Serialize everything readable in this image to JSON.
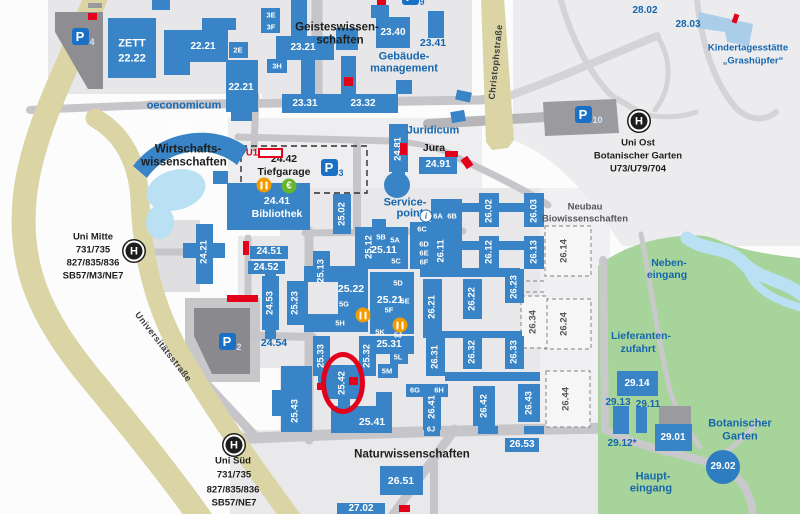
{
  "map": {
    "colors": {
      "building_blue": "#3884c6",
      "light_building": "#aacdea",
      "garage_gray": "#8e8e92",
      "road_gray": "#c6c6ca",
      "major_road_beige": "#dbd5a6",
      "green": "#a6d49a",
      "water": "#b9e1f3",
      "highlight_red": "#e2001a",
      "label_blue": "#1566ad",
      "text_black": "#1d1d1b",
      "parking_blue": "#1a70c4",
      "circle_building": "#2e7dc0"
    },
    "labels": [
      {
        "t": "ZETT",
        "x": 132,
        "y": 44,
        "k": "wbl"
      },
      {
        "t": "22.22",
        "x": 132,
        "y": 59,
        "k": "wbl"
      },
      {
        "t": "22.21",
        "x": 203,
        "y": 47,
        "k": "wb",
        "s": 10
      },
      {
        "t": "2E",
        "x": 238,
        "y": 50,
        "k": "wb",
        "s": 7.5
      },
      {
        "t": "22.21",
        "x": 241,
        "y": 88,
        "k": "wb",
        "s": 10
      },
      {
        "t": "3E",
        "x": 271,
        "y": 15,
        "k": "wb",
        "s": 7.5
      },
      {
        "t": "3F",
        "x": 271,
        "y": 27,
        "k": "wb",
        "s": 7.5
      },
      {
        "t": "23.21",
        "x": 303,
        "y": 48,
        "k": "wb",
        "s": 10
      },
      {
        "t": "3H",
        "x": 277,
        "y": 66,
        "k": "wb",
        "s": 7.5
      },
      {
        "t": "23.31",
        "x": 305,
        "y": 104,
        "k": "wb",
        "s": 10
      },
      {
        "t": "23.32",
        "x": 363,
        "y": 104,
        "k": "wb",
        "s": 10
      },
      {
        "t": "23.40",
        "x": 393,
        "y": 33,
        "k": "wb",
        "s": 10
      },
      {
        "t": "24.41",
        "x": 277,
        "y": 201,
        "k": "wbl",
        "s": 10.5
      },
      {
        "t": "Bibliothek",
        "x": 277,
        "y": 214,
        "k": "wbl",
        "s": 10.5
      },
      {
        "t": "24.91",
        "x": 438,
        "y": 165,
        "k": "wb",
        "s": 10
      },
      {
        "t": "24.31",
        "x": 184,
        "y": 130,
        "k": "wb",
        "s": 10
      },
      {
        "t": "24.51",
        "x": 269,
        "y": 252,
        "k": "wb",
        "s": 10
      },
      {
        "t": "24.52",
        "x": 266,
        "y": 268,
        "k": "wb",
        "s": 10
      },
      {
        "t": "5B",
        "x": 381,
        "y": 237,
        "k": "wb",
        "s": 7.5
      },
      {
        "t": "5A",
        "x": 395,
        "y": 240,
        "k": "wb",
        "s": 7.5
      },
      {
        "t": "25.11",
        "x": 384,
        "y": 250,
        "k": "wbl",
        "s": 10.5
      },
      {
        "t": "5C",
        "x": 396,
        "y": 261,
        "k": "wb",
        "s": 7.5
      },
      {
        "t": "6A",
        "x": 438,
        "y": 216,
        "k": "wb",
        "s": 7.5
      },
      {
        "t": "6B",
        "x": 452,
        "y": 216,
        "k": "wb",
        "s": 7.5
      },
      {
        "t": "6C",
        "x": 422,
        "y": 229,
        "k": "wb",
        "s": 7.5
      },
      {
        "t": "6D",
        "x": 424,
        "y": 244,
        "k": "wb",
        "s": 7.5
      },
      {
        "t": "6E",
        "x": 424,
        "y": 253,
        "k": "wb",
        "s": 7.5
      },
      {
        "t": "6F",
        "x": 424,
        "y": 262,
        "k": "wb",
        "s": 7.5
      },
      {
        "t": "25.22",
        "x": 351,
        "y": 289,
        "k": "wbl",
        "s": 10.5
      },
      {
        "t": "5G",
        "x": 344,
        "y": 304,
        "k": "wb",
        "s": 7.5
      },
      {
        "t": "5H",
        "x": 340,
        "y": 323,
        "k": "wb",
        "s": 7.5
      },
      {
        "t": "25.21",
        "x": 390,
        "y": 300,
        "k": "wbl",
        "s": 10.5
      },
      {
        "t": "5D",
        "x": 398,
        "y": 283,
        "k": "wb",
        "s": 7.5
      },
      {
        "t": "5E",
        "x": 405,
        "y": 301,
        "k": "wb",
        "s": 7.5
      },
      {
        "t": "5F",
        "x": 389,
        "y": 310,
        "k": "wb",
        "s": 7.5
      },
      {
        "t": "5K",
        "x": 380,
        "y": 332,
        "k": "wb",
        "s": 7.5
      },
      {
        "t": "5J",
        "x": 398,
        "y": 335,
        "k": "wb",
        "s": 7.5
      },
      {
        "t": "25.31",
        "x": 389,
        "y": 345,
        "k": "wb",
        "s": 10
      },
      {
        "t": "5L",
        "x": 398,
        "y": 357,
        "k": "wb",
        "s": 7.5
      },
      {
        "t": "5M",
        "x": 387,
        "y": 371,
        "k": "wb",
        "s": 7.5
      },
      {
        "t": "6G",
        "x": 415,
        "y": 390,
        "k": "wb",
        "s": 7.5
      },
      {
        "t": "6H",
        "x": 439,
        "y": 390,
        "k": "wb",
        "s": 7.5
      },
      {
        "t": "6J",
        "x": 431,
        "y": 429,
        "k": "wb",
        "s": 7.5
      },
      {
        "t": "25.41",
        "x": 372,
        "y": 422,
        "k": "wbl",
        "s": 10.5
      },
      {
        "t": "26.51",
        "x": 401,
        "y": 481,
        "k": "wbl",
        "s": 10.5
      },
      {
        "t": "26.53",
        "x": 522,
        "y": 445,
        "k": "wb",
        "s": 10
      },
      {
        "t": "27.02",
        "x": 361,
        "y": 509,
        "k": "wb",
        "s": 10
      },
      {
        "t": "29.14",
        "x": 637,
        "y": 384,
        "k": "wb",
        "s": 10
      },
      {
        "t": "29.01",
        "x": 673,
        "y": 438,
        "k": "wb",
        "s": 10
      },
      {
        "t": "29.02",
        "x": 723,
        "y": 467,
        "k": "wb",
        "s": 10
      },
      {
        "t": "24.21",
        "x": 204,
        "y": 252,
        "k": "wv"
      },
      {
        "t": "24.53",
        "x": 270,
        "y": 303,
        "k": "wv"
      },
      {
        "t": "24.81",
        "x": 398,
        "y": 149,
        "k": "wv"
      },
      {
        "t": "25.02",
        "x": 342,
        "y": 214,
        "k": "wv"
      },
      {
        "t": "25.12",
        "x": 369,
        "y": 247,
        "k": "wv"
      },
      {
        "t": "25.13",
        "x": 321,
        "y": 271,
        "k": "wv"
      },
      {
        "t": "25.23",
        "x": 295,
        "y": 303,
        "k": "wv"
      },
      {
        "t": "25.33",
        "x": 321,
        "y": 356,
        "k": "wv"
      },
      {
        "t": "25.32",
        "x": 367,
        "y": 356,
        "k": "wv"
      },
      {
        "t": "25.42",
        "x": 342,
        "y": 383,
        "k": "wv"
      },
      {
        "t": "25.43",
        "x": 295,
        "y": 411,
        "k": "wv"
      },
      {
        "t": "26.02",
        "x": 489,
        "y": 211,
        "k": "wv"
      },
      {
        "t": "26.03",
        "x": 534,
        "y": 211,
        "k": "wv"
      },
      {
        "t": "26.11",
        "x": 441,
        "y": 251,
        "k": "wv"
      },
      {
        "t": "26.12",
        "x": 489,
        "y": 252,
        "k": "wv"
      },
      {
        "t": "26.13",
        "x": 534,
        "y": 252,
        "k": "wv"
      },
      {
        "t": "26.21",
        "x": 432,
        "y": 307,
        "k": "wv"
      },
      {
        "t": "26.22",
        "x": 472,
        "y": 299,
        "k": "wv"
      },
      {
        "t": "26.23",
        "x": 514,
        "y": 287,
        "k": "wv"
      },
      {
        "t": "26.31",
        "x": 435,
        "y": 357,
        "k": "wv"
      },
      {
        "t": "26.32",
        "x": 472,
        "y": 352,
        "k": "wv"
      },
      {
        "t": "26.33",
        "x": 514,
        "y": 352,
        "k": "wv"
      },
      {
        "t": "26.41",
        "x": 432,
        "y": 407,
        "k": "wv"
      },
      {
        "t": "26.42",
        "x": 484,
        "y": 406,
        "k": "wv"
      },
      {
        "t": "26.43",
        "x": 529,
        "y": 403,
        "k": "wv"
      },
      {
        "t": "26.14",
        "x": 564,
        "y": 251,
        "k": "gv"
      },
      {
        "t": "26.24",
        "x": 564,
        "y": 324,
        "k": "gv"
      },
      {
        "t": "26.34",
        "x": 533,
        "y": 322,
        "k": "gv"
      },
      {
        "t": "26.44",
        "x": 566,
        "y": 399,
        "k": "gv"
      },
      {
        "t": "Neubau",
        "x": 585,
        "y": 207,
        "k": "g"
      },
      {
        "t": "Biowissenschaften",
        "x": 585,
        "y": 219,
        "k": "g"
      },
      {
        "t": "oeconomicum",
        "x": 184,
        "y": 106,
        "k": "bl"
      },
      {
        "t": "23.41",
        "x": 433,
        "y": 43,
        "k": "b",
        "s": 10.5
      },
      {
        "t": "Gebäude-",
        "x": 404,
        "y": 57,
        "k": "bl"
      },
      {
        "t": "management",
        "x": 404,
        "y": 69,
        "k": "bl"
      },
      {
        "t": "Juridicum",
        "x": 433,
        "y": 131,
        "k": "bl"
      },
      {
        "t": "Service-",
        "x": 405,
        "y": 203,
        "k": "bl"
      },
      {
        "t": "point",
        "x": 410,
        "y": 214,
        "k": "bl"
      },
      {
        "t": "24.54",
        "x": 274,
        "y": 343,
        "k": "b",
        "s": 10.5
      },
      {
        "t": "28.02",
        "x": 645,
        "y": 11,
        "k": "b",
        "s": 10
      },
      {
        "t": "28.03",
        "x": 688,
        "y": 25,
        "k": "b",
        "s": 10
      },
      {
        "t": "Kindertagesstätte",
        "x": 748,
        "y": 48,
        "k": "b"
      },
      {
        "t": "„Grashüpfer“",
        "x": 753,
        "y": 61,
        "k": "b"
      },
      {
        "t": "Neben-",
        "x": 669,
        "y": 263,
        "k": "b",
        "s": 10.5
      },
      {
        "t": "eingang",
        "x": 667,
        "y": 275,
        "k": "b",
        "s": 10.5
      },
      {
        "t": "Lieferanten-",
        "x": 641,
        "y": 336,
        "k": "b",
        "s": 10.5
      },
      {
        "t": "zufahrt",
        "x": 638,
        "y": 349,
        "k": "b",
        "s": 10.5
      },
      {
        "t": "29.13",
        "x": 618,
        "y": 403,
        "k": "b",
        "s": 10
      },
      {
        "t": "29.11",
        "x": 648,
        "y": 405,
        "k": "b",
        "s": 10
      },
      {
        "t": "29.12*",
        "x": 622,
        "y": 444,
        "k": "b",
        "s": 10
      },
      {
        "t": "Botanischer",
        "x": 740,
        "y": 424,
        "k": "bl"
      },
      {
        "t": "Garten",
        "x": 740,
        "y": 437,
        "k": "bl"
      },
      {
        "t": "Haupt-",
        "x": 653,
        "y": 477,
        "k": "bl"
      },
      {
        "t": "eingang",
        "x": 651,
        "y": 489,
        "k": "bl"
      },
      {
        "t": "U1",
        "x": 252,
        "y": 153,
        "k": "r"
      },
      {
        "t": "24.42",
        "x": 284,
        "y": 159,
        "k": "k",
        "s": 10.5
      },
      {
        "t": "Tiefgarage",
        "x": 284,
        "y": 172,
        "k": "k",
        "s": 10.5
      },
      {
        "t": "Jura",
        "x": 434,
        "y": 148,
        "k": "k",
        "s": 10.5
      },
      {
        "t": "Uni Mitte",
        "x": 93,
        "y": 237,
        "k": "k"
      },
      {
        "t": "731/735",
        "x": 93,
        "y": 250,
        "k": "k"
      },
      {
        "t": "827/835/836",
        "x": 93,
        "y": 263,
        "k": "k"
      },
      {
        "t": "SB57/M3/NE7",
        "x": 93,
        "y": 276,
        "k": "k"
      },
      {
        "t": "Uni Ost",
        "x": 638,
        "y": 143,
        "k": "k"
      },
      {
        "t": "Botanischer Garten",
        "x": 638,
        "y": 156,
        "k": "k"
      },
      {
        "t": "U73/U79/704",
        "x": 638,
        "y": 169,
        "k": "k"
      },
      {
        "t": "Uni Süd",
        "x": 233,
        "y": 461,
        "k": "k"
      },
      {
        "t": "731/735",
        "x": 234,
        "y": 475,
        "k": "k"
      },
      {
        "t": "827/835/836",
        "x": 233,
        "y": 490,
        "k": "k"
      },
      {
        "t": "SB57/NE7",
        "x": 234,
        "y": 503,
        "k": "k"
      },
      {
        "t": "Geisteswissen-",
        "x": 337,
        "y": 28,
        "k": "kl"
      },
      {
        "t": "schaften",
        "x": 340,
        "y": 41,
        "k": "kl"
      },
      {
        "t": "Wirtschafts-",
        "x": 188,
        "y": 150,
        "k": "kl"
      },
      {
        "t": "wissenschaften",
        "x": 184,
        "y": 163,
        "k": "kl"
      },
      {
        "t": "Naturwissenschaften",
        "x": 412,
        "y": 455,
        "k": "kl"
      },
      {
        "t": "Christophstraße",
        "x": 496,
        "y": 62,
        "k": "st",
        "r": -84
      },
      {
        "t": "Universitätsstraße",
        "x": 163,
        "y": 347,
        "k": "st",
        "r": 52
      }
    ],
    "parking_signs": [
      {
        "p": "P",
        "n": "4",
        "x": 80,
        "y": 36,
        "dark": true
      },
      {
        "p": "P",
        "n": "3",
        "x": 329,
        "y": 167,
        "dark": false
      },
      {
        "p": "P",
        "n": "2",
        "x": 227,
        "y": 341,
        "dark": true
      },
      {
        "p": "P",
        "n": "10",
        "x": 583,
        "y": 114,
        "dark": true
      },
      {
        "p": "P",
        "n": "9",
        "x": 410,
        "y": -4,
        "dark": false
      }
    ],
    "bus_stops": {
      "letter": "H",
      "positions": [
        {
          "x": 134,
          "y": 251
        },
        {
          "x": 639,
          "y": 121
        },
        {
          "x": 234,
          "y": 445
        }
      ]
    },
    "icons": [
      {
        "type": "restaurant",
        "x": 264,
        "y": 185
      },
      {
        "type": "restaurant",
        "x": 363,
        "y": 315
      },
      {
        "type": "restaurant",
        "x": 400,
        "y": 325
      },
      {
        "type": "euro",
        "glyph": "€",
        "x": 289,
        "y": 186
      },
      {
        "type": "info",
        "glyph": "i",
        "x": 426,
        "y": 216
      }
    ],
    "red_markers": [
      {
        "x": 88,
        "y": 13,
        "w": 9,
        "h": 7,
        "rot": 0
      },
      {
        "x": 377,
        "y": 0,
        "w": 9,
        "h": 5,
        "rot": 0
      },
      {
        "x": 733,
        "y": 14,
        "w": 5,
        "h": 9,
        "rot": 20
      },
      {
        "x": 344,
        "y": 77,
        "w": 9,
        "h": 9,
        "rot": 0
      },
      {
        "x": 400,
        "y": 143,
        "w": 7,
        "h": 12,
        "rot": 0
      },
      {
        "x": 445,
        "y": 151,
        "w": 13,
        "h": 6,
        "rot": 0
      },
      {
        "x": 463,
        "y": 157,
        "w": 8,
        "h": 11,
        "rot": -35
      },
      {
        "x": 243,
        "y": 241,
        "w": 6,
        "h": 14,
        "rot": 0
      },
      {
        "x": 227,
        "y": 295,
        "w": 31,
        "h": 7,
        "rot": 0
      },
      {
        "x": 317,
        "y": 383,
        "w": 7,
        "h": 7,
        "rot": 0
      },
      {
        "x": 349,
        "y": 377,
        "w": 9,
        "h": 8,
        "rot": 0
      },
      {
        "x": 399,
        "y": 505,
        "w": 11,
        "h": 7,
        "rot": 0
      }
    ],
    "red_outline_box": {
      "x": 258,
      "y": 148,
      "w": 25,
      "h": 10
    },
    "highlight": {
      "x": 321,
      "y": 352,
      "w": 44,
      "h": 62
    }
  }
}
